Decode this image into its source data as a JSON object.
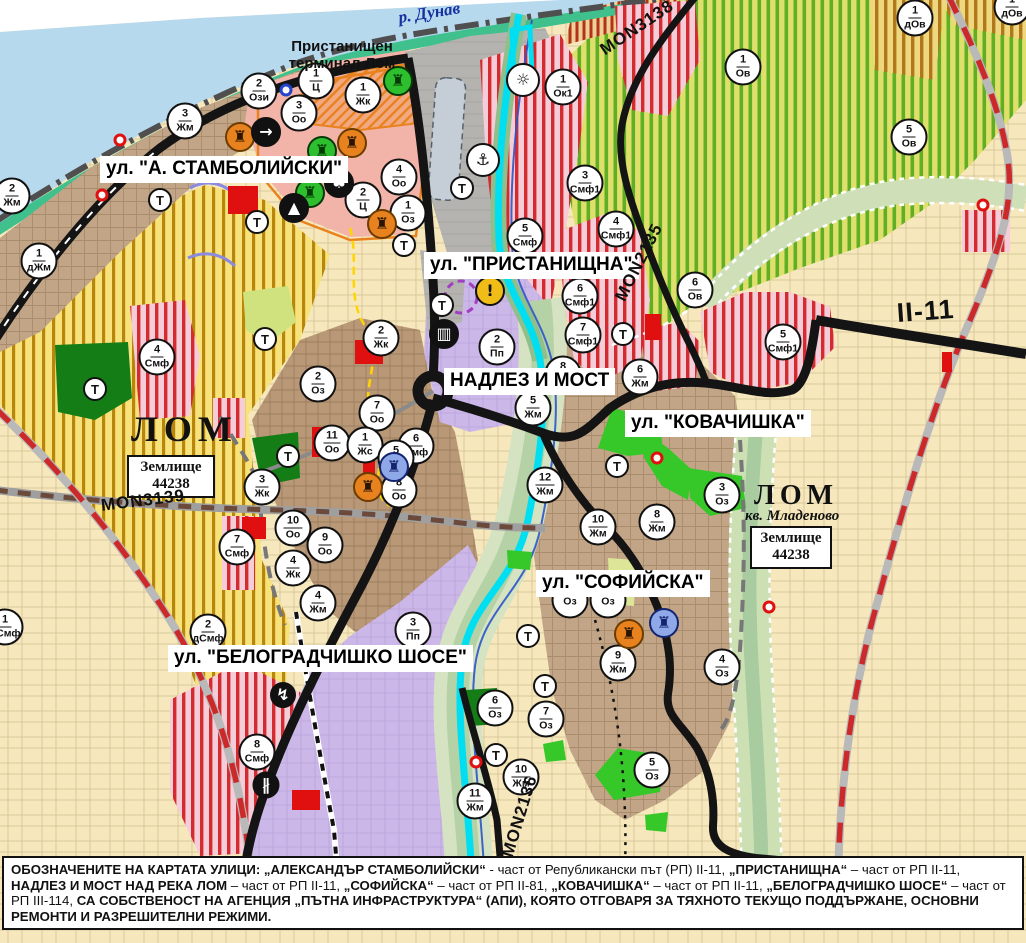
{
  "map": {
    "street_labels": [
      {
        "name": "street-label-stamboliyski",
        "text": "ул. \"А. СТАМБОЛИЙСКИ\"",
        "x": 100,
        "y": 156
      },
      {
        "name": "street-label-pristanishtna",
        "text": "ул. \"ПРИСТАНИЩНА\"",
        "x": 424,
        "y": 252
      },
      {
        "name": "street-label-nadlez-i-most",
        "text": "НАДЛЕЗ И МОСТ",
        "x": 444,
        "y": 368
      },
      {
        "name": "street-label-kovachishka",
        "text": "ул. \"КОВАЧИШКА\"",
        "x": 625,
        "y": 410
      },
      {
        "name": "street-label-sofiyska",
        "text": "ул. \"СОФИЙСКА\"",
        "x": 536,
        "y": 570
      },
      {
        "name": "street-label-belogradchishko",
        "text": "ул. \"БЕЛОГРАДЧИШКО ШОСЕ\"",
        "x": 168,
        "y": 645
      }
    ],
    "road_labels": [
      {
        "name": "road-label-mon3138",
        "text": "MON3138",
        "x": 597,
        "y": 44,
        "rot": -34,
        "size": 17
      },
      {
        "name": "road-label-mon3139",
        "text": "MON3139",
        "x": 100,
        "y": 497,
        "rot": -7,
        "size": 17
      },
      {
        "name": "road-label-mon2135",
        "text": "MON2135",
        "x": 612,
        "y": 296,
        "rot": -63,
        "size": 17
      },
      {
        "name": "road-label-mon2136",
        "text": "MON2136",
        "x": 499,
        "y": 854,
        "rot": -73,
        "size": 17
      },
      {
        "name": "road-label-ii-11",
        "text": "II-11",
        "x": 896,
        "y": 300,
        "rot": -4,
        "size": 27
      }
    ],
    "place_labels": [
      {
        "name": "river-label-danube",
        "text": "р. Дунав",
        "x": 397,
        "y": 8,
        "rot": -9,
        "size": 17,
        "serif": true,
        "italic": true,
        "color": "#15309f"
      },
      {
        "name": "place-label-port-terminal",
        "lines": [
          "Пристанищен",
          "терминал Лом"
        ],
        "x": 286,
        "y": 38,
        "size": 15,
        "w": 112,
        "align": "center",
        "color": "#111"
      },
      {
        "name": "place-label-lom",
        "text": "ЛОМ",
        "x": 131,
        "y": 408,
        "size": 36,
        "serif": true,
        "ls": 6,
        "color": "#111"
      },
      {
        "name": "cadastre-box-lom",
        "lines": [
          "Землище",
          "44238"
        ],
        "x": 127,
        "y": 455,
        "w": 88,
        "box": true
      },
      {
        "name": "place-label-lom-mladenovo",
        "text": "ЛОМ",
        "x": 754,
        "y": 480,
        "size": 28,
        "serif": true,
        "ls": 5,
        "color": "#111"
      },
      {
        "name": "place-label-kv-mladenovo",
        "text": "кв. Младеново",
        "x": 745,
        "y": 508,
        "size": 15,
        "serif": true,
        "italic": true,
        "color": "#111"
      },
      {
        "name": "cadastre-box-mladenovo",
        "lines": [
          "Землище",
          "44238"
        ],
        "x": 750,
        "y": 526,
        "w": 82,
        "box": true
      }
    ],
    "markers": [
      {
        "n": "3",
        "c": "Жм",
        "x": 185,
        "y": 121
      },
      {
        "n": "2",
        "c": "Ози",
        "x": 259,
        "y": 91
      },
      {
        "n": "1",
        "c": "Ц",
        "x": 316,
        "y": 81
      },
      {
        "n": "3",
        "c": "Оо",
        "x": 299,
        "y": 113
      },
      {
        "n": "1",
        "c": "Жк",
        "x": 363,
        "y": 95
      },
      {
        "n": "2",
        "c": "Жм",
        "x": 12,
        "y": 196
      },
      {
        "n": "1",
        "c": "дЖм",
        "x": 39,
        "y": 261
      },
      {
        "n": "4",
        "c": "Оо",
        "x": 399,
        "y": 177
      },
      {
        "n": "2",
        "c": "Ц",
        "x": 363,
        "y": 200
      },
      {
        "n": "1",
        "c": "Оз",
        "x": 408,
        "y": 213
      },
      {
        "n": "1",
        "c": "Ок1",
        "x": 563,
        "y": 87
      },
      {
        "n": "5",
        "c": "Смф",
        "x": 525,
        "y": 236
      },
      {
        "n": "3",
        "c": "Смф1",
        "x": 585,
        "y": 183
      },
      {
        "n": "4",
        "c": "Смф1",
        "x": 616,
        "y": 229
      },
      {
        "n": "6",
        "c": "Смф1",
        "x": 580,
        "y": 296
      },
      {
        "n": "7",
        "c": "Смф1",
        "x": 583,
        "y": 335
      },
      {
        "n": "2",
        "c": "Пп",
        "x": 497,
        "y": 347
      },
      {
        "n": "6",
        "c": "Ов",
        "x": 695,
        "y": 290
      },
      {
        "n": "1",
        "c": "Ов",
        "x": 743,
        "y": 67
      },
      {
        "n": "1",
        "c": "дОв",
        "x": 915,
        "y": 18
      },
      {
        "n": "1",
        "c": "дОв",
        "x": 1012,
        "y": 7
      },
      {
        "n": "5",
        "c": "Ов",
        "x": 909,
        "y": 137
      },
      {
        "n": "5",
        "c": "Смф1",
        "x": 783,
        "y": 342
      },
      {
        "n": "6",
        "c": "Жм",
        "x": 640,
        "y": 377
      },
      {
        "n": "8",
        "c": "Жм",
        "x": 563,
        "y": 374
      },
      {
        "n": "5",
        "c": "Жм",
        "x": 533,
        "y": 408
      },
      {
        "n": "12",
        "c": "Жм",
        "x": 545,
        "y": 485
      },
      {
        "n": "8",
        "c": "Жм",
        "x": 657,
        "y": 522
      },
      {
        "n": "10",
        "c": "Жм",
        "x": 598,
        "y": 527
      },
      {
        "n": "3",
        "c": "Оз",
        "x": 722,
        "y": 495
      },
      {
        "n": "4",
        "c": "Смф",
        "x": 157,
        "y": 357
      },
      {
        "n": "2",
        "c": "Жк",
        "x": 381,
        "y": 338
      },
      {
        "n": "2",
        "c": "Оз",
        "x": 318,
        "y": 384
      },
      {
        "n": "7",
        "c": "Оо",
        "x": 377,
        "y": 413
      },
      {
        "n": "11",
        "c": "Оо",
        "x": 332,
        "y": 443
      },
      {
        "n": "1",
        "c": "Жс",
        "x": 365,
        "y": 445
      },
      {
        "n": "6",
        "c": "Смф",
        "x": 416,
        "y": 446
      },
      {
        "n": "5",
        "c": "Смф",
        "x": 396,
        "y": 458
      },
      {
        "n": "8",
        "c": "Оо",
        "x": 399,
        "y": 490
      },
      {
        "n": "3",
        "c": "Жк",
        "x": 262,
        "y": 487
      },
      {
        "n": "10",
        "c": "Оо",
        "x": 293,
        "y": 528
      },
      {
        "n": "9",
        "c": "Оо",
        "x": 325,
        "y": 545
      },
      {
        "n": "7",
        "c": "Смф",
        "x": 237,
        "y": 547
      },
      {
        "n": "4",
        "c": "Жк",
        "x": 293,
        "y": 568
      },
      {
        "n": "4",
        "c": "Жм",
        "x": 318,
        "y": 603
      },
      {
        "n": "2",
        "c": "дСмф",
        "x": 208,
        "y": 632
      },
      {
        "n": "1",
        "c": "дСмф",
        "x": 5,
        "y": 627
      },
      {
        "n": "3",
        "c": "Пп",
        "x": 413,
        "y": 630
      },
      {
        "n": "8",
        "c": "Смф",
        "x": 257,
        "y": 752
      },
      {
        "n": "9",
        "c": "Жм",
        "x": 618,
        "y": 663
      },
      {
        "n": "4",
        "c": "Оз",
        "x": 722,
        "y": 667
      },
      {
        "n": "6",
        "c": "Оз",
        "x": 495,
        "y": 708
      },
      {
        "n": "7",
        "c": "Оз",
        "x": 546,
        "y": 719
      },
      {
        "n": "10",
        "c": "Жм",
        "x": 521,
        "y": 777
      },
      {
        "n": "11",
        "c": "Жм",
        "x": 475,
        "y": 801
      },
      {
        "n": "5",
        "c": "Оз",
        "x": 652,
        "y": 770
      },
      {
        "n": "",
        "c": "Оз",
        "x": 570,
        "y": 600
      },
      {
        "n": "",
        "c": "Оз",
        "x": 608,
        "y": 600
      }
    ],
    "t_markers": [
      {
        "t": "Т",
        "x": 160,
        "y": 200
      },
      {
        "t": "Т",
        "x": 257,
        "y": 222
      },
      {
        "t": "Т",
        "x": 265,
        "y": 339
      },
      {
        "t": "Т",
        "x": 288,
        "y": 456
      },
      {
        "t": "Т",
        "x": 95,
        "y": 389
      },
      {
        "t": "Т",
        "x": 404,
        "y": 245
      },
      {
        "t": "Т",
        "x": 442,
        "y": 305
      },
      {
        "t": "Т",
        "x": 462,
        "y": 188
      },
      {
        "t": "Т",
        "x": 623,
        "y": 334
      },
      {
        "t": "Т",
        "x": 617,
        "y": 466
      },
      {
        "t": "Т",
        "x": 528,
        "y": 636
      },
      {
        "t": "Т",
        "x": 545,
        "y": 686
      },
      {
        "t": "Т",
        "x": 496,
        "y": 755
      }
    ],
    "icons": [
      {
        "k": "monument-icon",
        "g": "♜",
        "bg": "#e8821e",
        "fg": "#2a1600",
        "bd": "#6b3c00",
        "x": 240,
        "y": 137
      },
      {
        "k": "monument-icon",
        "g": "♜",
        "bg": "#e8821e",
        "fg": "#2a1600",
        "bd": "#6b3c00",
        "x": 352,
        "y": 143
      },
      {
        "k": "circle-arrow-icon",
        "g": "→",
        "bg": "#111",
        "fg": "#fff",
        "bd": "#111",
        "x": 266,
        "y": 132
      },
      {
        "k": "monument-icon",
        "g": "♜",
        "bg": "#2ebf2e",
        "fg": "#063a06",
        "bd": "#063a06",
        "x": 322,
        "y": 151
      },
      {
        "k": "monument-icon",
        "g": "♜",
        "bg": "#2ebf2e",
        "fg": "#063a06",
        "bd": "#063a06",
        "x": 310,
        "y": 193
      },
      {
        "k": "trefoil-icon",
        "g": "♣",
        "bg": "#111",
        "fg": "#fff",
        "bd": "#111",
        "x": 339,
        "y": 183
      },
      {
        "k": "mound-icon",
        "g": "▲",
        "bg": "#111",
        "fg": "#fff",
        "bd": "#111",
        "x": 294,
        "y": 208
      },
      {
        "k": "monument-icon",
        "g": "♜",
        "bg": "#e8821e",
        "fg": "#2a1600",
        "bd": "#6b3c00",
        "x": 382,
        "y": 224
      },
      {
        "k": "monument-icon",
        "g": "♜",
        "bg": "#2ebf2e",
        "fg": "#063a06",
        "bd": "#063a06",
        "x": 398,
        "y": 81
      },
      {
        "k": "anchor-port-icon",
        "g": "⚓",
        "bg": "#fff",
        "fg": "#111",
        "bd": "#111",
        "x": 483,
        "y": 160,
        "s": 34
      },
      {
        "k": "fan-icon",
        "g": "☼",
        "bg": "#fff",
        "fg": "#111",
        "bd": "#111",
        "x": 523,
        "y": 80,
        "s": 34
      },
      {
        "k": "truck-terminal-icon",
        "g": "▥",
        "bg": "#111",
        "fg": "#fff",
        "bd": "#111",
        "x": 444,
        "y": 334
      },
      {
        "k": "warning-icon",
        "g": "!",
        "bg": "#f0bc18",
        "fg": "#111",
        "bd": "#111",
        "x": 490,
        "y": 291
      },
      {
        "k": "monument-icon",
        "g": "♜",
        "bg": "#e8821e",
        "fg": "#2a1600",
        "bd": "#6b3c00",
        "x": 368,
        "y": 487
      },
      {
        "k": "monument-icon",
        "g": "♜",
        "bg": "#8fa8e8",
        "fg": "#14246e",
        "bd": "#14246e",
        "x": 394,
        "y": 467
      },
      {
        "k": "monument-icon",
        "g": "♜",
        "bg": "#e8821e",
        "fg": "#2a1600",
        "bd": "#6b3c00",
        "x": 629,
        "y": 634
      },
      {
        "k": "monument-icon",
        "g": "♜",
        "bg": "#8fa8e8",
        "fg": "#14246e",
        "bd": "#14246e",
        "x": 664,
        "y": 623
      },
      {
        "k": "lightning-icon",
        "g": "↯",
        "bg": "#111",
        "fg": "#fff",
        "bd": "#111",
        "x": 283,
        "y": 695,
        "s": 26
      },
      {
        "k": "railway-crossing-icon",
        "g": "∦",
        "bg": "#111",
        "fg": "#fff",
        "bd": "#111",
        "x": 266,
        "y": 785,
        "s": 27
      }
    ],
    "dots": [
      {
        "x": 120,
        "y": 140,
        "color": "#e01010"
      },
      {
        "x": 102,
        "y": 195,
        "color": "#e01010"
      },
      {
        "x": 657,
        "y": 458,
        "color": "#e01010"
      },
      {
        "x": 476,
        "y": 762,
        "color": "#e01010"
      },
      {
        "x": 983,
        "y": 205,
        "color": "#e01010"
      },
      {
        "x": 769,
        "y": 607,
        "color": "#e01010"
      },
      {
        "x": 286,
        "y": 90,
        "color": "#2244cc"
      }
    ]
  },
  "footer": {
    "segments": [
      {
        "text": "ОБОЗНАЧЕНИТЕ НА КАРТАТА УЛИЦИ: „АЛЕКСАНДЪР СТАМБОЛИЙСКИ“",
        "bold": true
      },
      {
        "text": " - част от Републикански път (РП) II-11, ",
        "bold": false
      },
      {
        "text": "„ПРИСТАНИЩНА“",
        "bold": true
      },
      {
        "text": " – част от РП II-11, ",
        "bold": false
      },
      {
        "text": "НАДЛЕЗ И МОСТ НАД РЕКА ЛОМ",
        "bold": true
      },
      {
        "text": " – част от РП II-11, ",
        "bold": false
      },
      {
        "text": "„СОФИЙСКА“",
        "bold": true
      },
      {
        "text": " – част от РП II-81, ",
        "bold": false
      },
      {
        "text": "„КОВАЧИШКА“",
        "bold": true
      },
      {
        "text": " – част от РП II-11, ",
        "bold": false
      },
      {
        "text": "„БЕЛОГРАДЧИШКО ШОСЕ“",
        "bold": true
      },
      {
        "text": " – част от РП III-114, ",
        "bold": false
      },
      {
        "text": "СА СОБСТВЕНОСТ НА АГЕНЦИЯ „ПЪТНА ИНФРАСТРУКТУРА“ (АПИ), КОЯТО ОТГОВАРЯ ЗА ТЯХНОТО ТЕКУЩО ПОДДЪРЖАНЕ, ОСНОВНИ РЕМОНТИ И РАЗРЕШИТЕЛНИ РЕЖИМИ.",
        "bold": true
      }
    ]
  },
  "colors": {
    "water": "#b7d9ee",
    "vineyard_stripe": "#5fae25",
    "residential_tan": "#c2a586",
    "mixed_use_stripe": "#d42b30",
    "industrial_purple": "#ccb8e8",
    "public_green": "#35c828",
    "farmland_beige": "#f6e8bc",
    "road_black": "#141414",
    "canal_cyan": "#00dff2",
    "projected_road_dash": "#cc2a2a",
    "shore_green": "#3fc08c"
  }
}
